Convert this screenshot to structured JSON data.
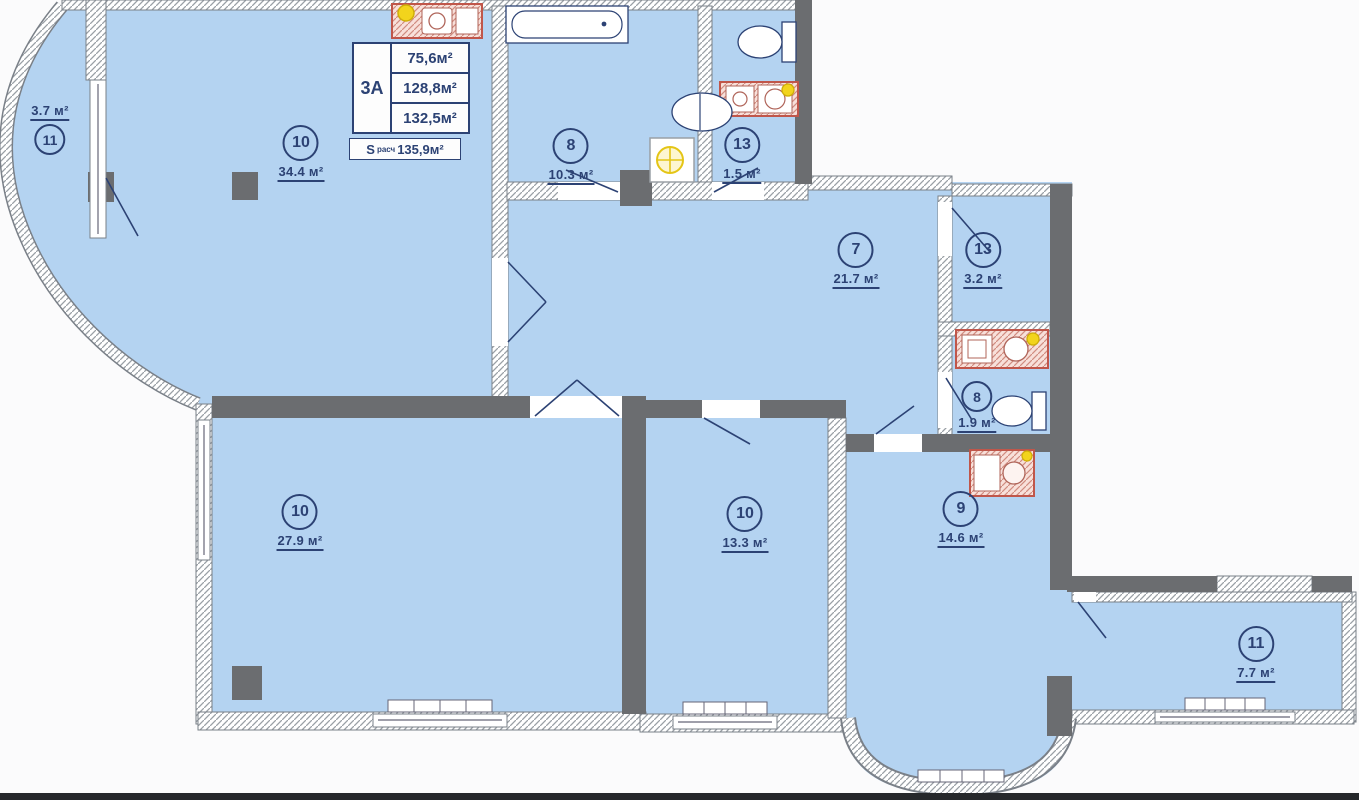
{
  "title": "Apartment floor plan 3А",
  "info_box": {
    "unit": "3А",
    "rows": [
      "75,6м²",
      "128,8м²",
      "132,5м²"
    ],
    "s_label": "S",
    "s_sub": "расч",
    "s_value": "135,9м²"
  },
  "rooms": [
    {
      "number": "11",
      "area": "3.7 м²"
    },
    {
      "number": "10",
      "area": "34.4 м²"
    },
    {
      "number": "8",
      "area": "10.3 м²"
    },
    {
      "number": "13",
      "area": "1.5 м²"
    },
    {
      "number": "7",
      "area": "21.7 м²"
    },
    {
      "number": "13",
      "area": "3.2 м²"
    },
    {
      "number": "8",
      "area": "1.9 м²"
    },
    {
      "number": "10",
      "area": "27.9 м²"
    },
    {
      "number": "10",
      "area": "13.3 м²"
    },
    {
      "number": "9",
      "area": "14.6 м²"
    },
    {
      "number": "11",
      "area": "7.7 м²"
    }
  ],
  "fixtures": [
    "bathtub-icon",
    "toilet-icon",
    "sink-icon",
    "washing-machine-icon",
    "kitchen-sink-icon",
    "water-heater-icon",
    "radiator-icon"
  ],
  "colors": {
    "room_fill": "#b4d3f1",
    "wall_dark": "#6b6d70",
    "line_navy": "#2c4274",
    "fixture_red": "#c0564a",
    "fixture_pink": "#f8e0da",
    "accent_yellow": "#f2d41c",
    "hatch_gray": "#9aa0a6",
    "page_bg": "#fbfbfc"
  }
}
